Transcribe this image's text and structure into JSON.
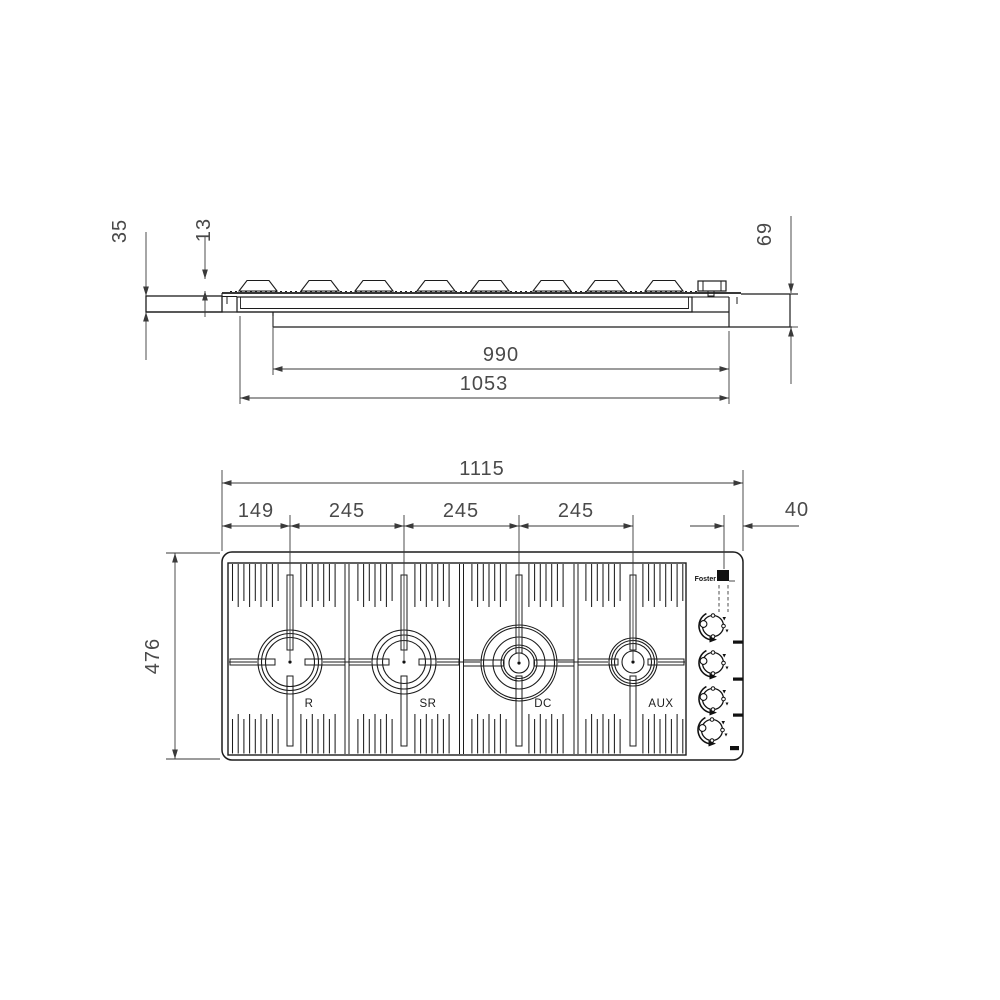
{
  "drawing_type": "technical installation drawing - built-in gas hob, side section and top plan view",
  "side_view": {
    "dims": {
      "d35": "35",
      "d13": "13",
      "d69": "69",
      "d990": "990",
      "d1053": "1053"
    }
  },
  "plan_view": {
    "dims": {
      "d1115": "1115",
      "d149": "149",
      "d245a": "245",
      "d245b": "245",
      "d245c": "245",
      "d40": "40",
      "d476": "476"
    },
    "burners": [
      {
        "label": "R"
      },
      {
        "label": "SR"
      },
      {
        "label": "DC"
      },
      {
        "label": "AUX"
      }
    ],
    "brand": "Foster",
    "knob_count": 4
  },
  "colors": {
    "line": "#1c1c1c",
    "dim_line": "#3a3a3a",
    "text": "#4a4a4a",
    "background": "#ffffff"
  }
}
